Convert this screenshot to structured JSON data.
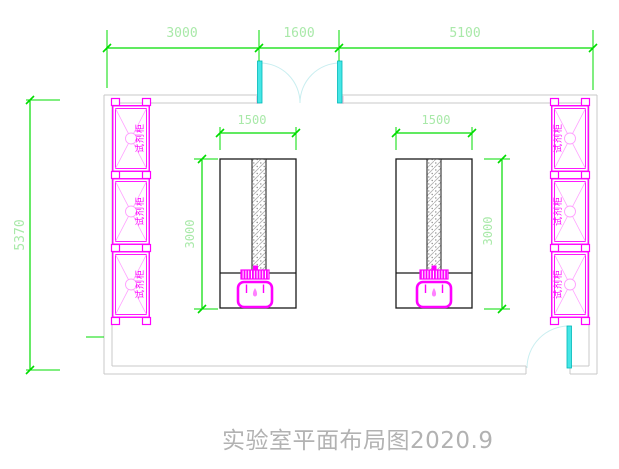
{
  "title": "实验室平面布局图2020.9",
  "dims": {
    "top_left": "3000",
    "top_door": "1600",
    "top_right": "5100",
    "wall_height": "5370",
    "bench_left_width": "1500",
    "bench_left_depth": "3000",
    "bench_right_width": "1500",
    "bench_right_depth": "3000"
  },
  "cabinets": {
    "left": [
      "试剂柜",
      "试剂柜",
      "试剂柜"
    ],
    "right": [
      "试剂柜",
      "试剂柜",
      "试剂柜"
    ]
  },
  "colors": {
    "dimension_line": "#00dd00",
    "dimension_text": "#a9e9a9",
    "cabinet_magenta": "#ff00ff",
    "door_cyan": "#45e6e6",
    "door_arc": "#c9eef0",
    "wall_gray": "#c9c9c9",
    "bench_outline": "#1a1a1a",
    "title_text": "#b2b2b2"
  }
}
